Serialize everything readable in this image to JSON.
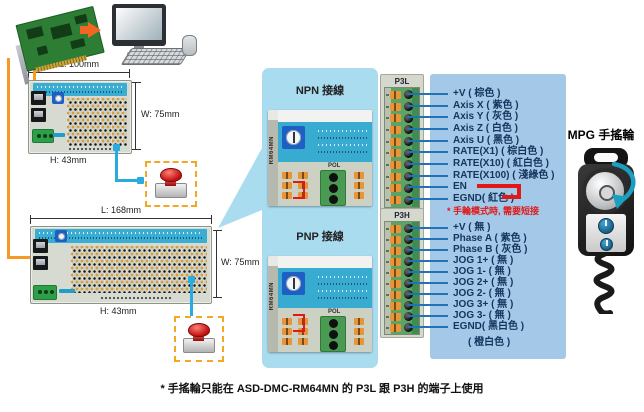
{
  "boards": {
    "board1": {
      "dim_l": "L: 100mm",
      "dim_w": "W: 75mm",
      "dim_h": "H: 43mm"
    },
    "board2": {
      "dim_l": "L: 168mm",
      "dim_w": "W: 75mm",
      "dim_h": "H: 43mm"
    }
  },
  "wiring_panel": {
    "npn_title": "NPN 接線",
    "pnp_title": "PNP 接線",
    "pol_label": "POL",
    "module_side_label": "RM64MN"
  },
  "p3l": {
    "title": "P3L",
    "pins": [
      "+V ( 棕色 )",
      "Axis X ( 紫色 )",
      "Axis Y ( 灰色 )",
      "Axis Z ( 白色 )",
      "Axis U ( 黑色 )",
      "RATE(X1) ( 棕白色 )",
      "RATE(X10) ( 紅白色 )",
      "RATE(X100) ( 淺綠色 )",
      "EN",
      "EGND( 紅色 )"
    ],
    "en_note": "* 手輪模式時, 需要短接"
  },
  "p3h": {
    "title": "P3H",
    "pins": [
      "+V ( 無 )",
      "Phase A ( 紫色 )",
      "Phase B ( 灰色 )",
      "JOG 1+ ( 無 )",
      "JOG 1- ( 無 )",
      "JOG 2+ ( 無 )",
      "JOG 2- ( 無 )",
      "JOG 3+ ( 無 )",
      "JOG 3- ( 無 )",
      "EGND( 黑白色 )"
    ],
    "egnd_second_color": "( 橙白色 )"
  },
  "mpg": {
    "title": "MPG 手搖輪"
  },
  "footnote": "* 手搖輪只能在 ASD-DMC-RM64MN 的 P3L 跟 P3H 的端子上使用",
  "colors": {
    "panel_blue": "#aadcf0",
    "pin_panel_blue": "#a3c8e8",
    "leader_blue": "#2272b8",
    "accent_red": "#e01818",
    "wire_orange": "#f59a23",
    "wire_cyan": "#29abe2"
  }
}
